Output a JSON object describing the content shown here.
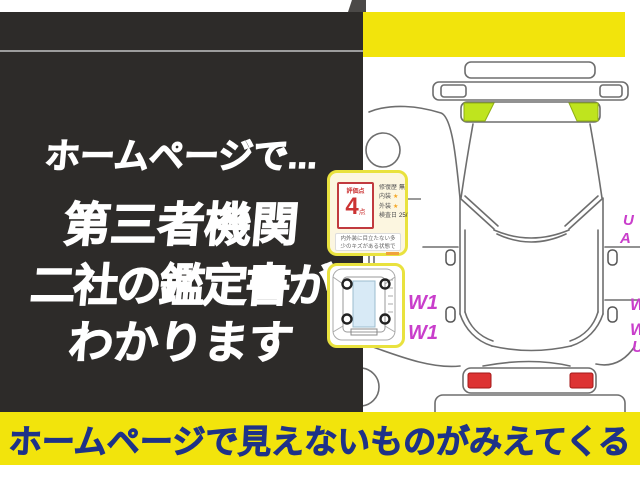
{
  "left_panel": {
    "lines": [
      "ホームページで...",
      "第三者機関",
      "二社の鑑定書が",
      "わかります"
    ]
  },
  "banner": {
    "text": "ホームページで見えないものがみえてくる"
  },
  "rating_card": {
    "score_label": "評価点",
    "score_value": "4",
    "score_unit": "点",
    "rows": [
      {
        "label": "修復歴",
        "value": "無"
      },
      {
        "label": "内装",
        "value": "★"
      },
      {
        "label": "外装",
        "value": "★"
      },
      {
        "label": "検査日",
        "value": "25/"
      }
    ],
    "note": "内外装に目立たない多少のキズがある状態です。"
  },
  "diagram_labels": {
    "left": [
      "W1",
      "W1"
    ],
    "right": [
      "U",
      "A",
      "W",
      "W",
      "U"
    ]
  },
  "colors": {
    "accent_yellow": "#f2e40c",
    "panel_dark": "#2d2b29",
    "banner_text_navy": "#1e3288",
    "highlight_green": "#bfe41e",
    "tail_light_red": "#dd3333",
    "label_magenta": "#c93ecb",
    "score_red": "#cc3333",
    "card_border_yellow": "#e9e23e"
  }
}
